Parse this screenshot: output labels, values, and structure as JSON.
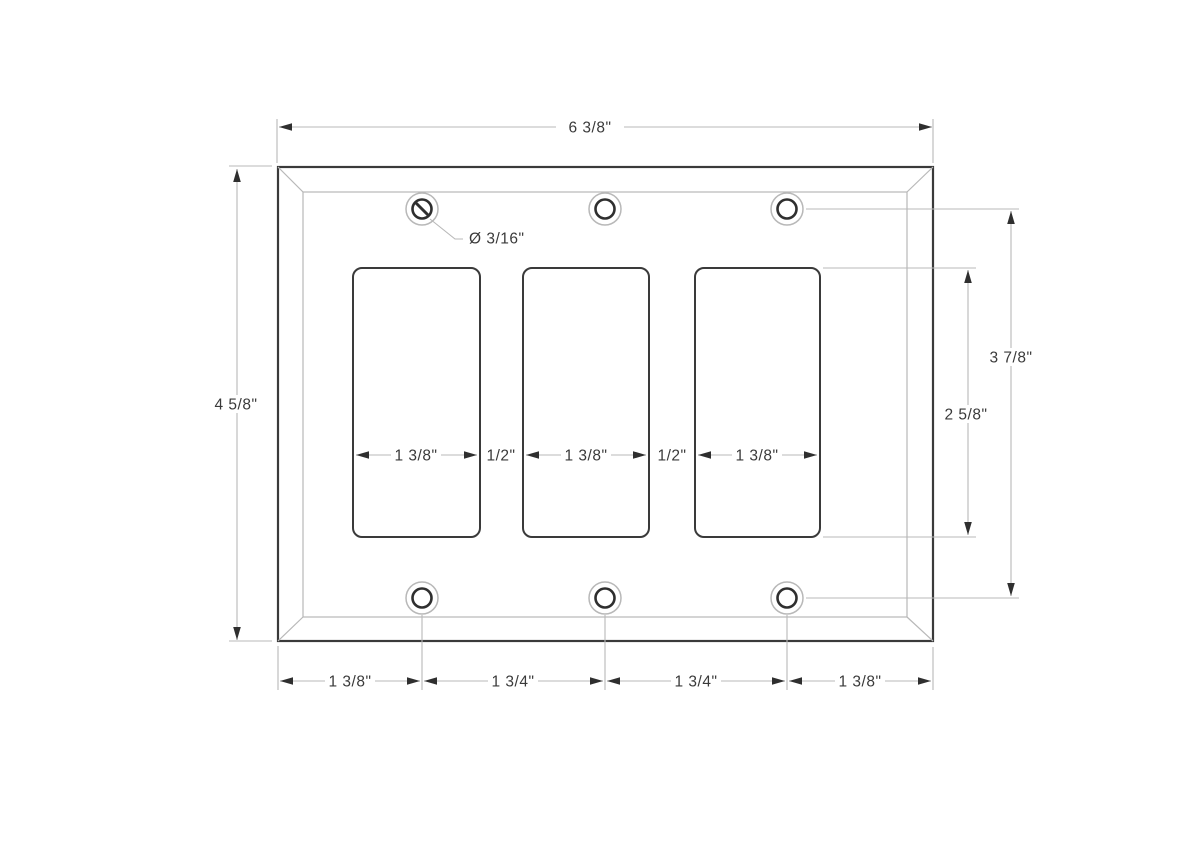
{
  "drawing": {
    "colors": {
      "line_dark": "#3a3a3a",
      "line_light": "#b8b8b8",
      "text": "#3a3a3a",
      "background": "#ffffff"
    },
    "labels": {
      "overall_width": "6 3/8\"",
      "overall_height": "4 5/8\"",
      "screw_span_height": "3 7/8\"",
      "opening_height": "2 5/8\"",
      "screw_hole_diameter": "Ø 3/16\"",
      "opening_widths": [
        "1 3/8\"",
        "1 3/8\"",
        "1 3/8\""
      ],
      "opening_gaps": [
        "1/2\"",
        "1/2\""
      ],
      "bottom_spacings": [
        "1 3/8\"",
        "1 3/4\"",
        "1 3/4\"",
        "1 3/8\""
      ]
    }
  }
}
